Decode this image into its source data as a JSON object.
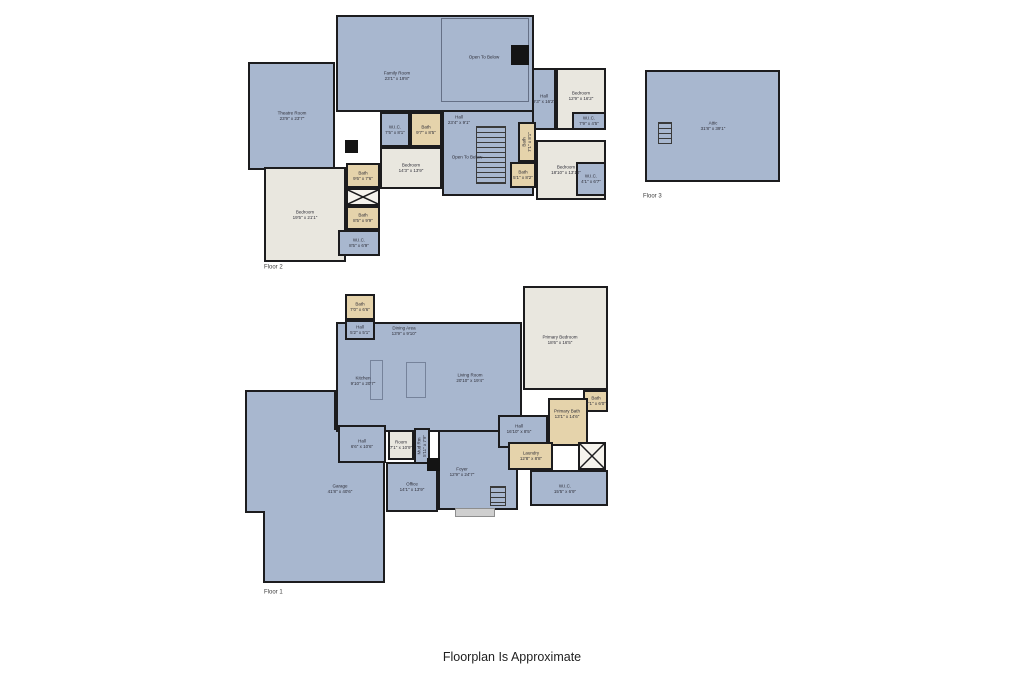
{
  "footer": {
    "text": "Floorplan Is Approximate"
  },
  "palette": {
    "room_blue": "#a8b7cf",
    "room_cream": "#e9e7df",
    "room_tan": "#e5d3ab",
    "wall": "#1c1c1e",
    "background": "#ffffff"
  },
  "floors": [
    {
      "id": "floor-2",
      "caption": "Floor 2",
      "rooms": [
        {
          "name": "family-room",
          "type": "blue",
          "x": 336,
          "y": 15,
          "w": 198,
          "h": 97,
          "label": "Family Room",
          "dims": "23'1\" x 19'8\"",
          "lx": 397,
          "ly": 76
        },
        {
          "name": "open-to-below-family",
          "type": "open",
          "x": 441,
          "y": 18,
          "w": 88,
          "h": 84,
          "label": "Open To Below",
          "lx": 484,
          "ly": 57
        },
        {
          "name": "chimney-block",
          "type": "solid",
          "x": 511,
          "y": 45,
          "w": 18,
          "h": 20
        },
        {
          "name": "theatre-room",
          "type": "blue",
          "x": 248,
          "y": 62,
          "w": 87,
          "h": 108,
          "label": "Theatre Room",
          "dims": "23'9\" x 23'7\""
        },
        {
          "name": "fireplace-block",
          "type": "solid",
          "x": 345,
          "y": 140,
          "w": 13,
          "h": 13
        },
        {
          "name": "hall-center",
          "type": "blue",
          "x": 442,
          "y": 110,
          "w": 92,
          "h": 86,
          "label": "Hall",
          "dims": "23'4\" x 9'1\"",
          "lx": 459,
          "ly": 120
        },
        {
          "name": "open-to-below-hall",
          "type": "label",
          "label": "Open To Below",
          "lx": 467,
          "ly": 157
        },
        {
          "name": "stairs-f2",
          "type": "stair",
          "x": 476,
          "y": 126,
          "w": 30,
          "h": 58
        },
        {
          "name": "hall-right",
          "type": "blue",
          "x": 532,
          "y": 68,
          "w": 24,
          "h": 62,
          "label": "Hall",
          "dims": "9'3\" x 16'2\""
        },
        {
          "name": "bedroom-right-top",
          "type": "cream",
          "x": 556,
          "y": 68,
          "w": 50,
          "h": 62,
          "label": "Bedroom",
          "dims": "12'9\" x 16'2\"",
          "lx": 581,
          "ly": 96
        },
        {
          "name": "wic-right-top",
          "type": "blue",
          "x": 572,
          "y": 112,
          "w": 34,
          "h": 18,
          "label": "W.I.C.",
          "dims": "7'9\" x 4'5\""
        },
        {
          "name": "bedroom-left",
          "type": "cream",
          "x": 264,
          "y": 167,
          "w": 82,
          "h": 95,
          "label": "Bedroom",
          "dims": "19'5\" x 21'1\""
        },
        {
          "name": "bath-1",
          "type": "tan",
          "x": 346,
          "y": 163,
          "w": 34,
          "h": 25,
          "label": "Bath",
          "dims": "9'6\" x 7'6\""
        },
        {
          "name": "closet-cross-f2",
          "type": "cross",
          "x": 346,
          "y": 188,
          "w": 34,
          "h": 18
        },
        {
          "name": "bath-2",
          "type": "tan",
          "x": 346,
          "y": 206,
          "w": 34,
          "h": 24,
          "label": "Bath",
          "dims": "8'5\" x 9'9\""
        },
        {
          "name": "wic-1",
          "type": "blue",
          "x": 338,
          "y": 230,
          "w": 42,
          "h": 26,
          "label": "W.I.C.",
          "dims": "8'5\" x 6'9\""
        },
        {
          "name": "wic-2",
          "type": "blue",
          "x": 380,
          "y": 112,
          "w": 30,
          "h": 35,
          "label": "W.I.C.",
          "dims": "7'5\" x 8'1\""
        },
        {
          "name": "bath-3",
          "type": "tan",
          "x": 410,
          "y": 112,
          "w": 32,
          "h": 35,
          "label": "Bath",
          "dims": "9'7\" x 8'5\""
        },
        {
          "name": "bedroom-center",
          "type": "cream",
          "x": 380,
          "y": 147,
          "w": 62,
          "h": 42,
          "label": "Bedroom",
          "dims": "14'3\" x 13'9\""
        },
        {
          "name": "bedroom-right-bottom",
          "type": "cream",
          "x": 536,
          "y": 140,
          "w": 70,
          "h": 60,
          "label": "Bedroom",
          "dims": "18'10\" x 13'10\"",
          "lx": 566,
          "ly": 170
        },
        {
          "name": "bath-4",
          "type": "tan",
          "x": 518,
          "y": 122,
          "w": 18,
          "h": 40,
          "label": "Bath",
          "dims": "7'1\" x 8'1\"",
          "rot": -90
        },
        {
          "name": "bath-5",
          "type": "tan",
          "x": 510,
          "y": 162,
          "w": 26,
          "h": 26,
          "label": "Bath",
          "dims": "5'1\" x 8'2\""
        },
        {
          "name": "wic-right-bottom",
          "type": "blue",
          "x": 576,
          "y": 162,
          "w": 30,
          "h": 34,
          "label": "W.I.C.",
          "dims": "4'1\" x 6'7\""
        }
      ]
    },
    {
      "id": "floor-3",
      "caption": "Floor 3",
      "rooms": [
        {
          "name": "attic",
          "type": "blue",
          "x": 645,
          "y": 70,
          "w": 135,
          "h": 112,
          "label": "Attic",
          "dims": "31'8\" x 39'1\""
        },
        {
          "name": "attic-stairs",
          "type": "stair",
          "x": 658,
          "y": 122,
          "w": 14,
          "h": 22
        }
      ]
    },
    {
      "id": "floor-1",
      "caption": "Floor 1",
      "rooms": [
        {
          "name": "garage-upper",
          "type": "blue",
          "x": 245,
          "y": 390,
          "w": 91,
          "h": 40
        },
        {
          "name": "garage-main",
          "type": "blue",
          "x": 245,
          "y": 428,
          "w": 140,
          "h": 85
        },
        {
          "name": "garage-lower",
          "type": "blue",
          "x": 263,
          "y": 513,
          "w": 122,
          "h": 70
        },
        {
          "name": "garage-seam-1",
          "type": "patch",
          "x": 247,
          "y": 426,
          "w": 87,
          "h": 6
        },
        {
          "name": "garage-seam-2",
          "type": "patch",
          "x": 265,
          "y": 509,
          "w": 118,
          "h": 8
        },
        {
          "name": "garage",
          "type": "label",
          "label": "Garage",
          "dims": "41'8\" x 40'6\"",
          "lx": 340,
          "ly": 489
        },
        {
          "name": "main-open-area",
          "type": "blue",
          "x": 336,
          "y": 322,
          "w": 186,
          "h": 110
        },
        {
          "name": "kitchen",
          "type": "label",
          "label": "Kitchen",
          "dims": "9'10\" x 20'7\"",
          "lx": 363,
          "ly": 381
        },
        {
          "name": "dining-area",
          "type": "label",
          "label": "Dining Area",
          "dims": "13'9\" x 9'10\"",
          "lx": 404,
          "ly": 331
        },
        {
          "name": "living-room",
          "type": "label",
          "label": "Living Room",
          "dims": "20'10\" x 19'4\"",
          "lx": 470,
          "ly": 378
        },
        {
          "name": "kitchen-counter",
          "type": "furniture",
          "x": 370,
          "y": 360,
          "w": 13,
          "h": 40
        },
        {
          "name": "kitchen-island",
          "type": "furniture",
          "x": 406,
          "y": 362,
          "w": 20,
          "h": 36
        },
        {
          "name": "bath-6",
          "type": "tan",
          "x": 345,
          "y": 294,
          "w": 30,
          "h": 26,
          "label": "Bath",
          "dims": "7'0\" x 6'6\""
        },
        {
          "name": "hall-small",
          "type": "blue",
          "x": 345,
          "y": 320,
          "w": 30,
          "h": 20,
          "label": "Hall",
          "dims": "5'2\" x 5'1\""
        },
        {
          "name": "primary-bedroom",
          "type": "cream",
          "x": 523,
          "y": 286,
          "w": 85,
          "h": 104,
          "label": "Primary Bedroom",
          "dims": "18'6\" x 16'5\"",
          "lx": 560,
          "ly": 340
        },
        {
          "name": "bath-7",
          "type": "tan",
          "x": 583,
          "y": 390,
          "w": 25,
          "h": 22,
          "label": "Bath",
          "dims": "7'1\" x 6'0\""
        },
        {
          "name": "primary-bath",
          "type": "tan",
          "x": 548,
          "y": 398,
          "w": 40,
          "h": 48,
          "label": "Primary Bath",
          "dims": "13'1\" x 14'6\"",
          "lx": 567,
          "ly": 414
        },
        {
          "name": "foyer",
          "type": "blue",
          "x": 438,
          "y": 430,
          "w": 80,
          "h": 80,
          "label": "Foyer",
          "dims": "12'9\" x 24'7\"",
          "lx": 462,
          "ly": 472
        },
        {
          "name": "hall-4",
          "type": "blue",
          "x": 498,
          "y": 415,
          "w": 50,
          "h": 33,
          "label": "Hall",
          "dims": "16'10\" x 8'5\"",
          "lx": 519,
          "ly": 429
        },
        {
          "name": "laundry",
          "type": "tan",
          "x": 508,
          "y": 442,
          "w": 45,
          "h": 28,
          "label": "Laundry",
          "dims": "12'8\" x 8'8\""
        },
        {
          "name": "closet-cross-f1",
          "type": "cross",
          "x": 578,
          "y": 442,
          "w": 28,
          "h": 28
        },
        {
          "name": "wic-5",
          "type": "blue",
          "x": 530,
          "y": 470,
          "w": 78,
          "h": 36,
          "label": "W.I.C.",
          "dims": "15'5\" x 6'9\"",
          "lx": 565,
          "ly": 489
        },
        {
          "name": "hall-5",
          "type": "blue",
          "x": 338,
          "y": 425,
          "w": 48,
          "h": 38,
          "label": "Hall",
          "dims": "6'6\" x 10'6\""
        },
        {
          "name": "room",
          "type": "cream",
          "x": 388,
          "y": 430,
          "w": 26,
          "h": 30,
          "label": "Room",
          "dims": "7'1\" x 10'9\""
        },
        {
          "name": "mud-rm",
          "type": "blue",
          "x": 414,
          "y": 428,
          "w": 16,
          "h": 36,
          "label": "Mud Rm",
          "dims": "5'11\" x 7'9\"",
          "rot": -90
        },
        {
          "name": "office",
          "type": "blue",
          "x": 386,
          "y": 462,
          "w": 52,
          "h": 50,
          "label": "Office",
          "dims": "14'1\" x 13'9\""
        },
        {
          "name": "entry-block",
          "type": "solid",
          "x": 427,
          "y": 458,
          "w": 13,
          "h": 13
        },
        {
          "name": "stairs-f1",
          "type": "stair",
          "x": 490,
          "y": 486,
          "w": 16,
          "h": 20
        },
        {
          "name": "entry-steps",
          "type": "porch",
          "x": 455,
          "y": 508,
          "w": 40,
          "h": 9
        }
      ]
    }
  ]
}
